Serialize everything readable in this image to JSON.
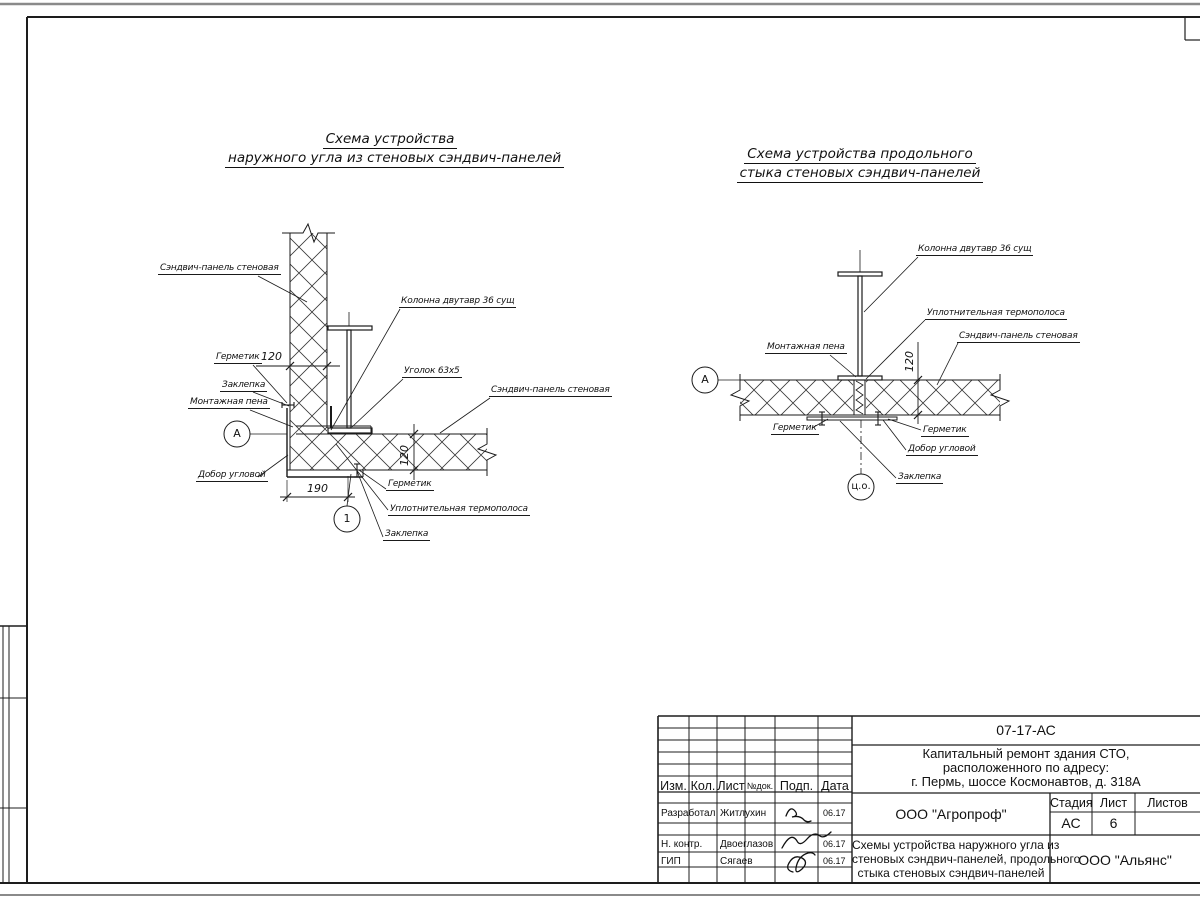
{
  "left_diagram": {
    "title1": "Схема устройства",
    "title2": "наружного угла из стеновых сэндвич-панелей",
    "labels": {
      "panel": "Сэндвич-панель стеновая",
      "sealant_top": "Герметик",
      "rivet_top": "Заклепка",
      "foam": "Монтажная пена",
      "corner_trim": "Добор угловой",
      "column": "Колонна двутавр 36 сущ",
      "angle": "Уголок 63х5",
      "panel_right": "Сэндвич-панель стеновая",
      "sealant_bottom": "Герметик",
      "thermo": "Уплотнительная термополоса",
      "rivet_bottom": "Заклепка"
    },
    "dims": {
      "panel_thickness_top": "120",
      "panel_thickness_right": "120",
      "corner_width": "190"
    },
    "marks": {
      "axis": "А",
      "node": "1"
    }
  },
  "right_diagram": {
    "title1": "Схема устройства продольного",
    "title2": "стыка стеновых сэндвич-панелей",
    "labels": {
      "column": "Колонна двутавр 36 сущ",
      "thermo": "Уплотнительная термополоса",
      "panel": "Сэндвич-панель стеновая",
      "foam": "Монтажная пена",
      "sealant_left": "Герметик",
      "sealant_right": "Герметик",
      "corner_trim": "Добор угловой",
      "rivet": "Заклепка"
    },
    "dims": {
      "panel_thickness": "120"
    },
    "marks": {
      "axis": "А",
      "center": "ц.о."
    }
  },
  "title_block": {
    "doc_number": "07-17-АС",
    "project_line1": "Капитальный ремонт здания СТО,",
    "project_line2": "расположенного по адресу:",
    "project_line3": "г. Пермь, шоссе Космонавтов, д. 318А",
    "col_izm": "Изм.",
    "col_kol": "Кол.",
    "col_list": "Лист",
    "col_ndok": "№док.",
    "col_podp": "Подп.",
    "col_data": "Дата",
    "row_developed_role": "Разработал",
    "row_developed_name": "Житлухин",
    "row_developed_date": "06.17",
    "row_ncontr_role": "Н. контр.",
    "row_ncontr_name": "Двоеглазов",
    "row_ncontr_date": "06.17",
    "row_gip_role": "ГИП",
    "row_gip_name": "Сягаев",
    "row_gip_date": "06.17",
    "org_design": "ООО \"Агропроф\"",
    "stage_label": "Стадия",
    "sheet_label": "Лист",
    "sheets_label": "Листов",
    "stage_value": "АС",
    "sheet_value": "6",
    "sheet_title_line1": "Схемы устройства наружного угла из",
    "sheet_title_line2": "стеновых сэндвич-панелей, продольного",
    "sheet_title_line3": "стыка стеновых сэндвич-панелей",
    "org_customer": "ООО \"Альянс\""
  }
}
